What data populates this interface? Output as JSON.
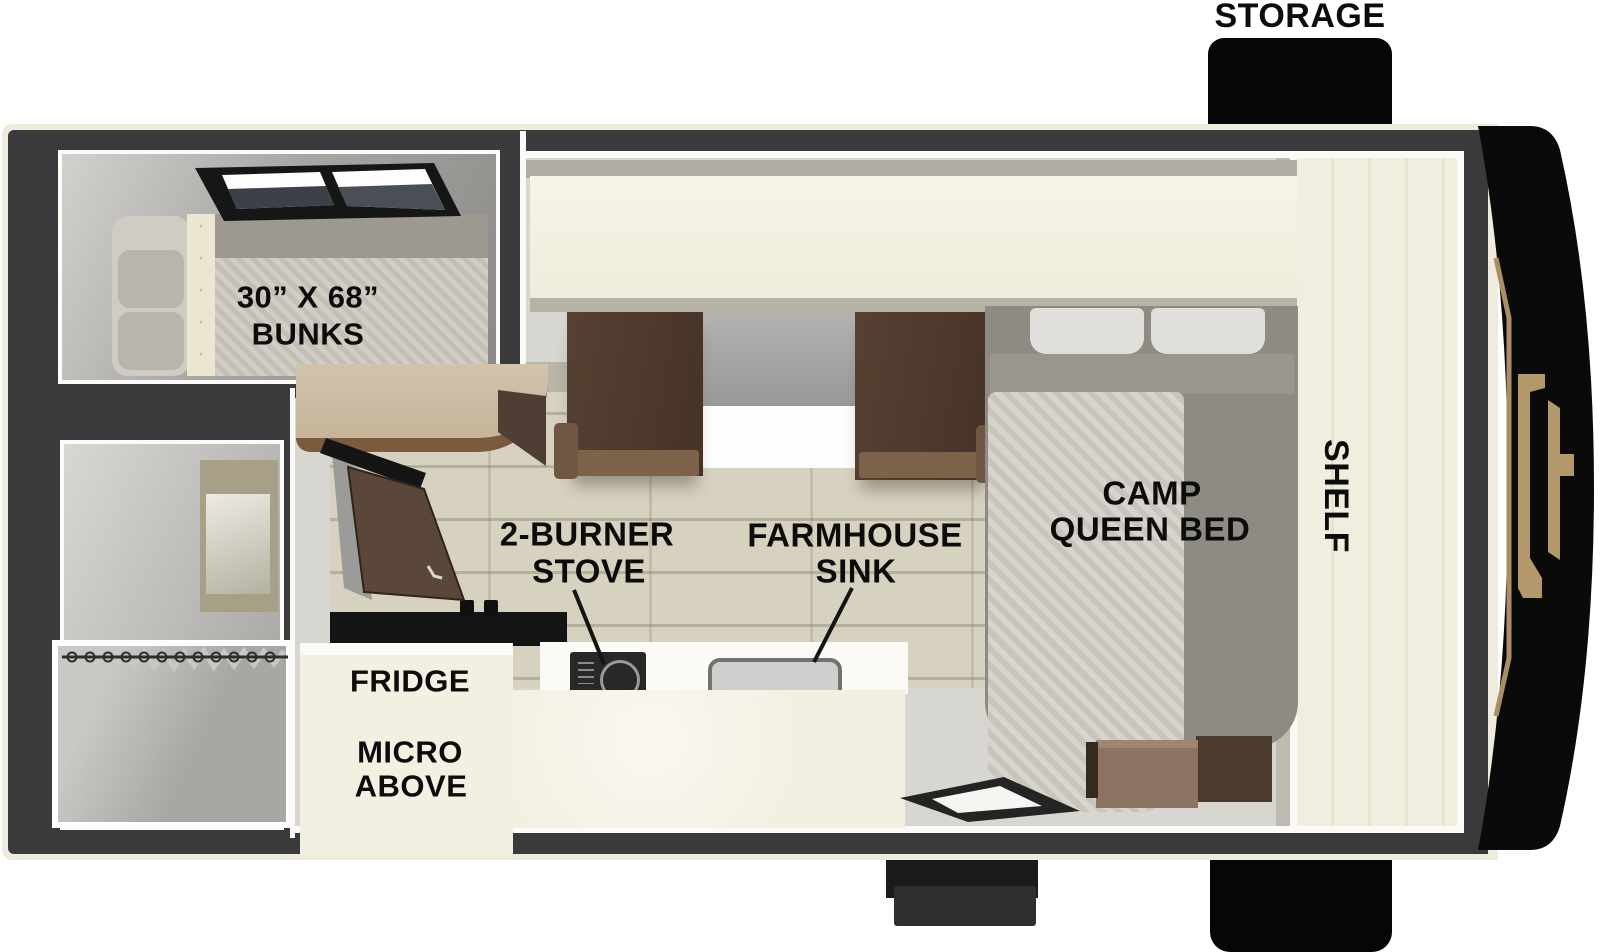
{
  "labels": {
    "storage": "STORAGE",
    "bunks_size": "30” X 68”",
    "bunks": "BUNKS",
    "stove_1": "2-BURNER",
    "stove_2": "STOVE",
    "sink_1": "FARMHOUSE",
    "sink_2": "SINK",
    "fridge": "FRIDGE",
    "micro_1": "MICRO",
    "micro_2": "ABOVE",
    "bed_1": "CAMP",
    "bed_2": "QUEEN BED",
    "shelf": "SHELF"
  },
  "colors": {
    "wall_charcoal": "#3a3a3c",
    "trim_cream": "#efecdd",
    "floor_gray": "#d8d6d1",
    "plank_beige": "#d7d1bf",
    "cabinet_brown": "#54402f",
    "counter_cream": "#f2efe0",
    "front_cap_black": "#0a0a0b",
    "logo_gold": "#b3986c",
    "label_text": "#0c0c0c"
  }
}
